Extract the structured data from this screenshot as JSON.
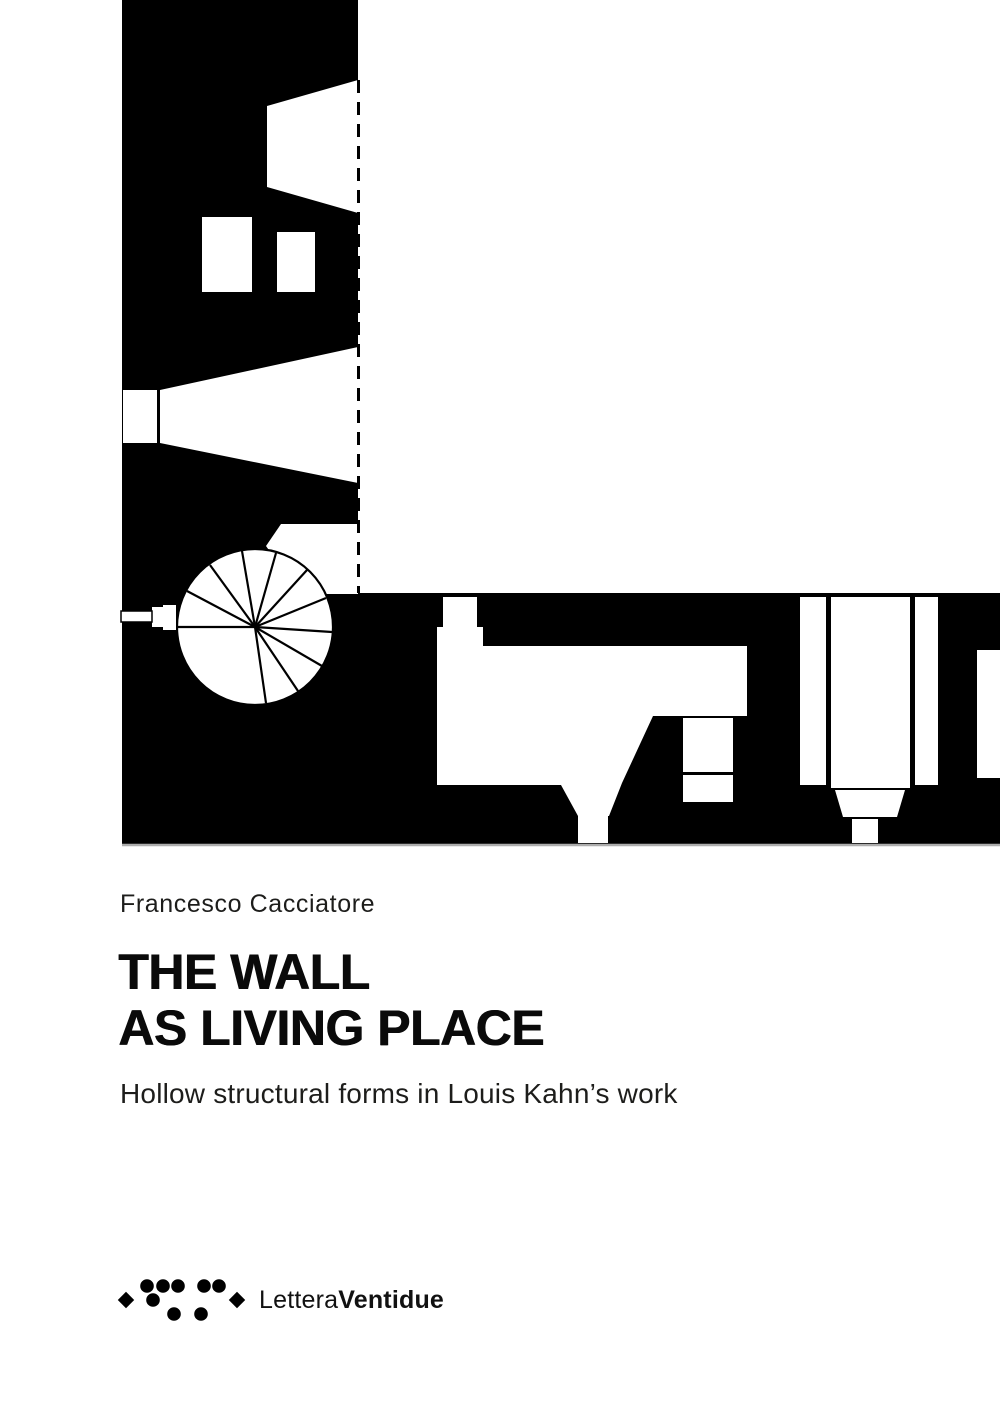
{
  "cover": {
    "author": "Francesco Cacciatore",
    "title": {
      "line1": "THE WALL",
      "line2": "AS LIVING PLACE"
    },
    "subtitle": "Hollow structural forms in Louis Kahn’s work",
    "publisher": {
      "name_regular": "Lettera",
      "name_bold": "Ventidue"
    },
    "colors": {
      "ink": "#000000",
      "paper": "#ffffff",
      "soft_ink": "#1d1d1b",
      "edge_shadow": "#adadad"
    }
  }
}
